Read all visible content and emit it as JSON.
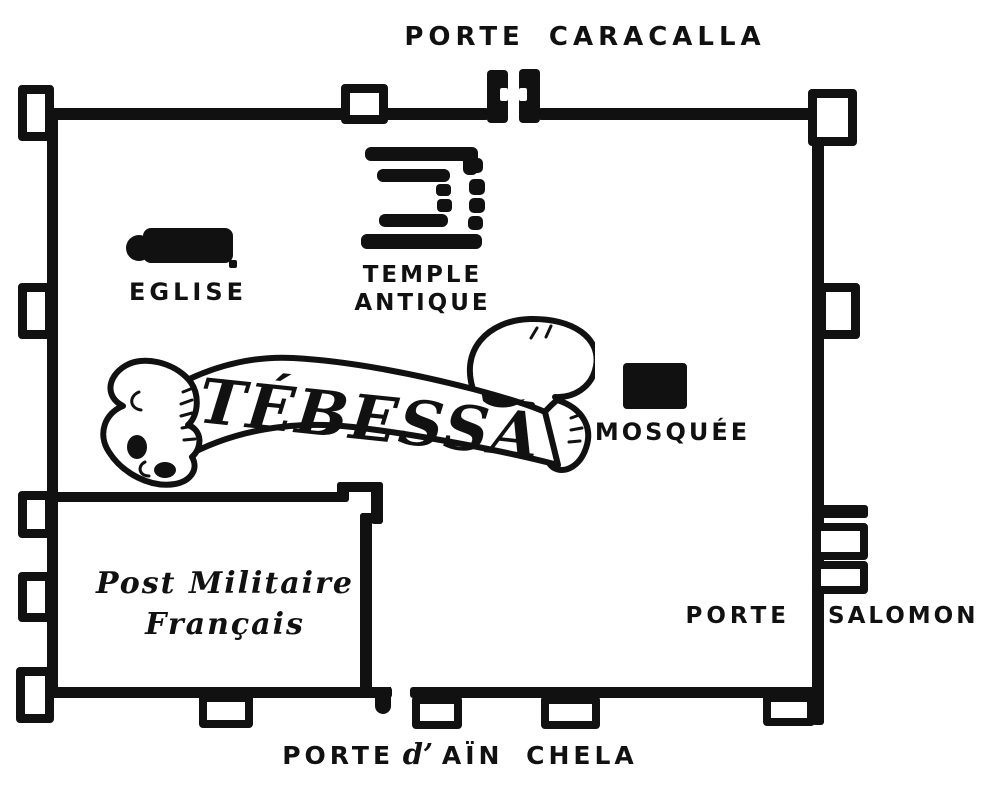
{
  "map": {
    "banner_title": "TÉBESSA",
    "gates": {
      "north": "PORTE CARACALLA",
      "east_word1": "PORTE",
      "east_word2": "SALOMON",
      "south_word1": "PORTE",
      "south_d": "d’",
      "south_word2": "AÏN CHELA"
    },
    "landmarks": {
      "eglise": "EGLISE",
      "temple_line1": "TEMPLE",
      "temple_line2": "ANTIQUE",
      "mosquee": "MOSQUÉE",
      "post_line1": "Post Militaire",
      "post_line2": "Français"
    },
    "colors": {
      "ink": "#111111",
      "paper": "#ffffff"
    }
  }
}
